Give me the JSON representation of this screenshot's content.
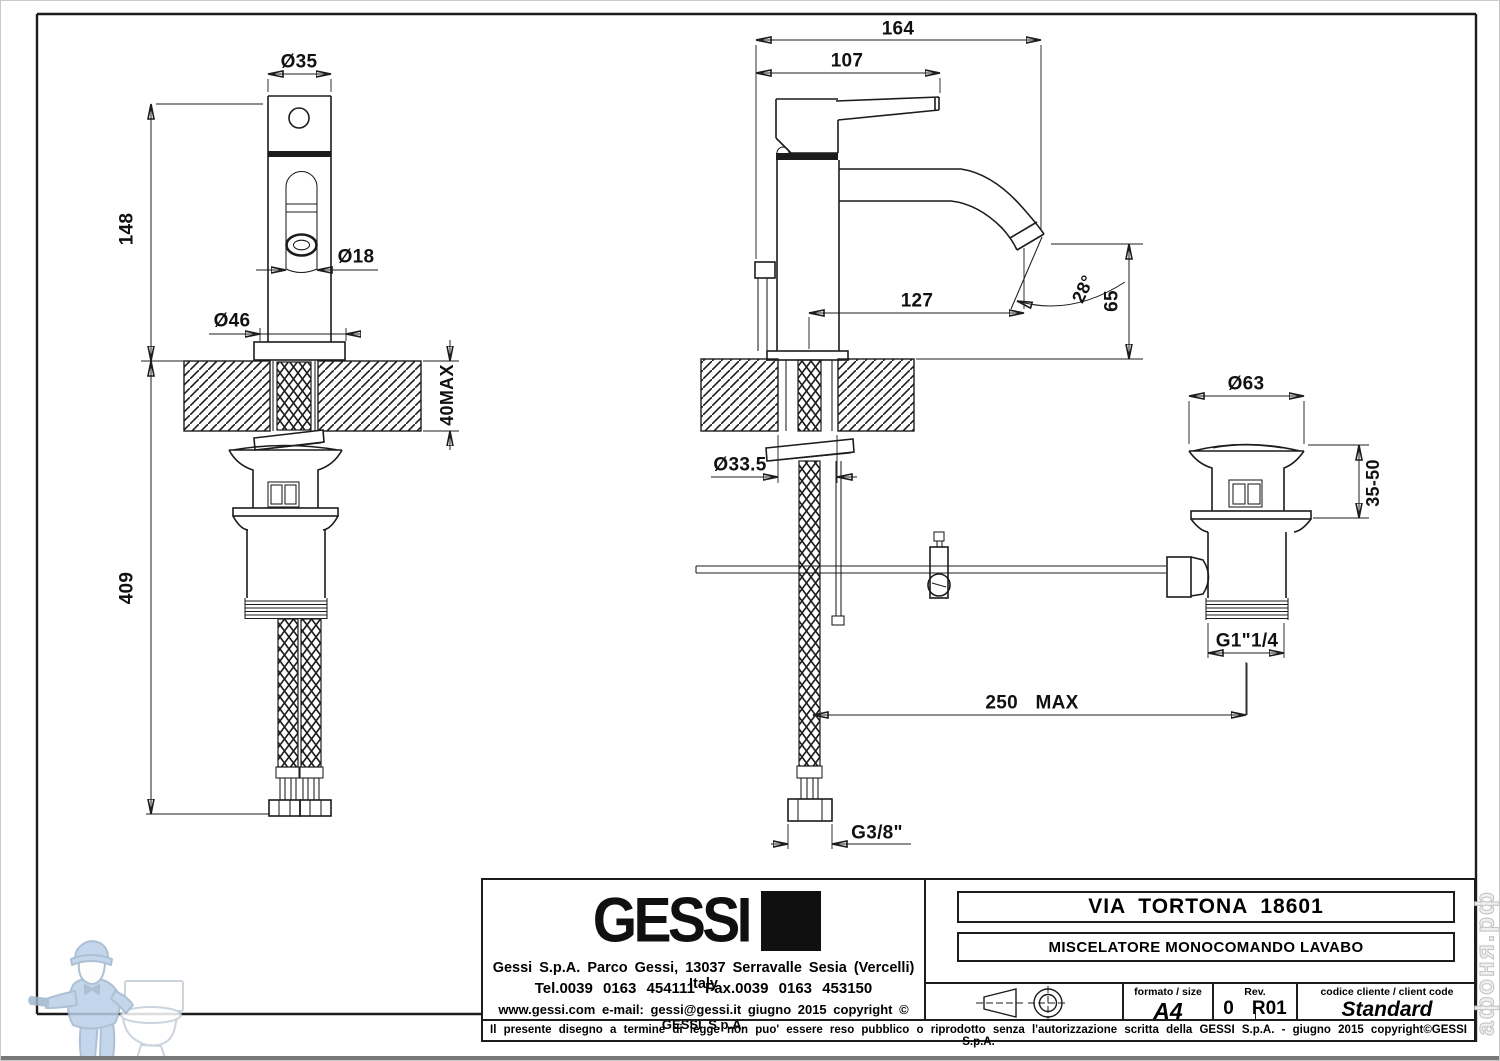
{
  "dims": {
    "front": {
      "dia_top": "Ø35",
      "height": "148",
      "spout_dia": "Ø18",
      "base_dia": "Ø46",
      "counter_max": "40MAX",
      "below_len": "409"
    },
    "side": {
      "depth_total": "164",
      "depth_handle": "107",
      "reach": "127",
      "angle": "28°",
      "spout_h": "65",
      "hole_dia": "Ø33.5",
      "span_max": "250 MAX",
      "supply_thread": "G3/8\""
    },
    "drain": {
      "flange_dia": "Ø63",
      "range": "35-50",
      "thread": "G1\"1/4"
    }
  },
  "title_block": {
    "logo_text": "GESSI",
    "address": "Gessi S.p.A. Parco Gessi, 13037 Serravalle Sesia (Vercelli) Italy",
    "phone": "Tel.0039 0163 454111 Fax.0039 0163 453150",
    "web": "www.gessi.com e-mail: gessi@gessi.it giugno 2015 copyright © GESSI S.p.A.",
    "product_series": "VIA TORTONA 18601",
    "product_description": "MISCELATORE MONOCOMANDO LAVABO",
    "format_label": "formato / size",
    "format_value": "A4",
    "rev_label": "Rev.",
    "rev_value_a": "0",
    "rev_value_b": "R01",
    "client_code_label": "codice cliente / client code",
    "client_code_value": "Standard",
    "legal_note": "Il presente disegno a termine di legge non puo' essere reso pubblico o riprodotto senza l'autorizzazione scritta della GESSI S.p.A. - giugno 2015 copyright©GESSI S.p.A."
  },
  "watermark": {
    "site": "афоня.рф"
  }
}
